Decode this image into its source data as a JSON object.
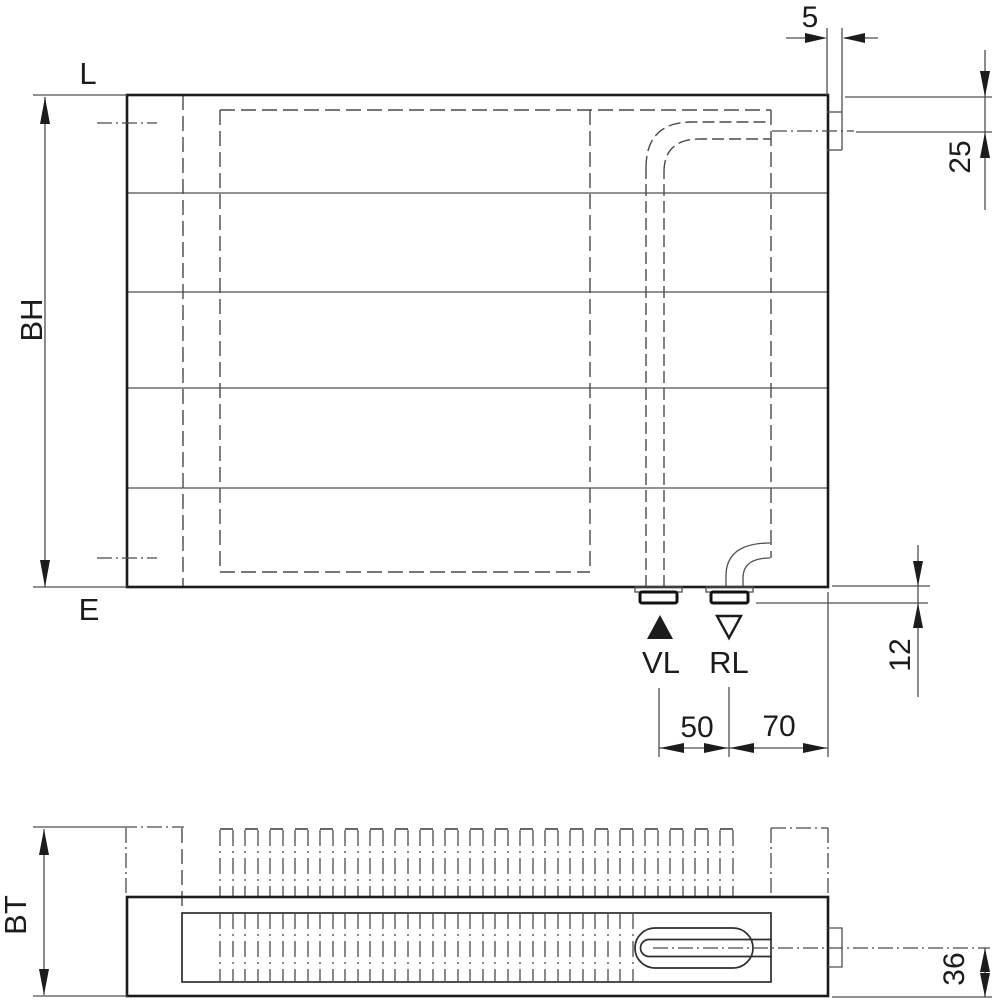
{
  "drawing": {
    "front": {
      "vent_label": "L",
      "drain_label": "E",
      "build_height_label": "BH",
      "tab_width_dim": "5",
      "connection_offset_dim": "25",
      "stub_depth_dim": "12",
      "pipe_spacing_dim": "50",
      "edge_spacing_dim": "70",
      "flow_label": "VL",
      "return_label": "RL"
    },
    "plan": {
      "build_depth_label": "BT",
      "pipe_center_dim": "36"
    },
    "colors": {
      "outline": "#1c1c1c",
      "thin_line": "#4f4f4f",
      "background": "#ffffff"
    }
  }
}
